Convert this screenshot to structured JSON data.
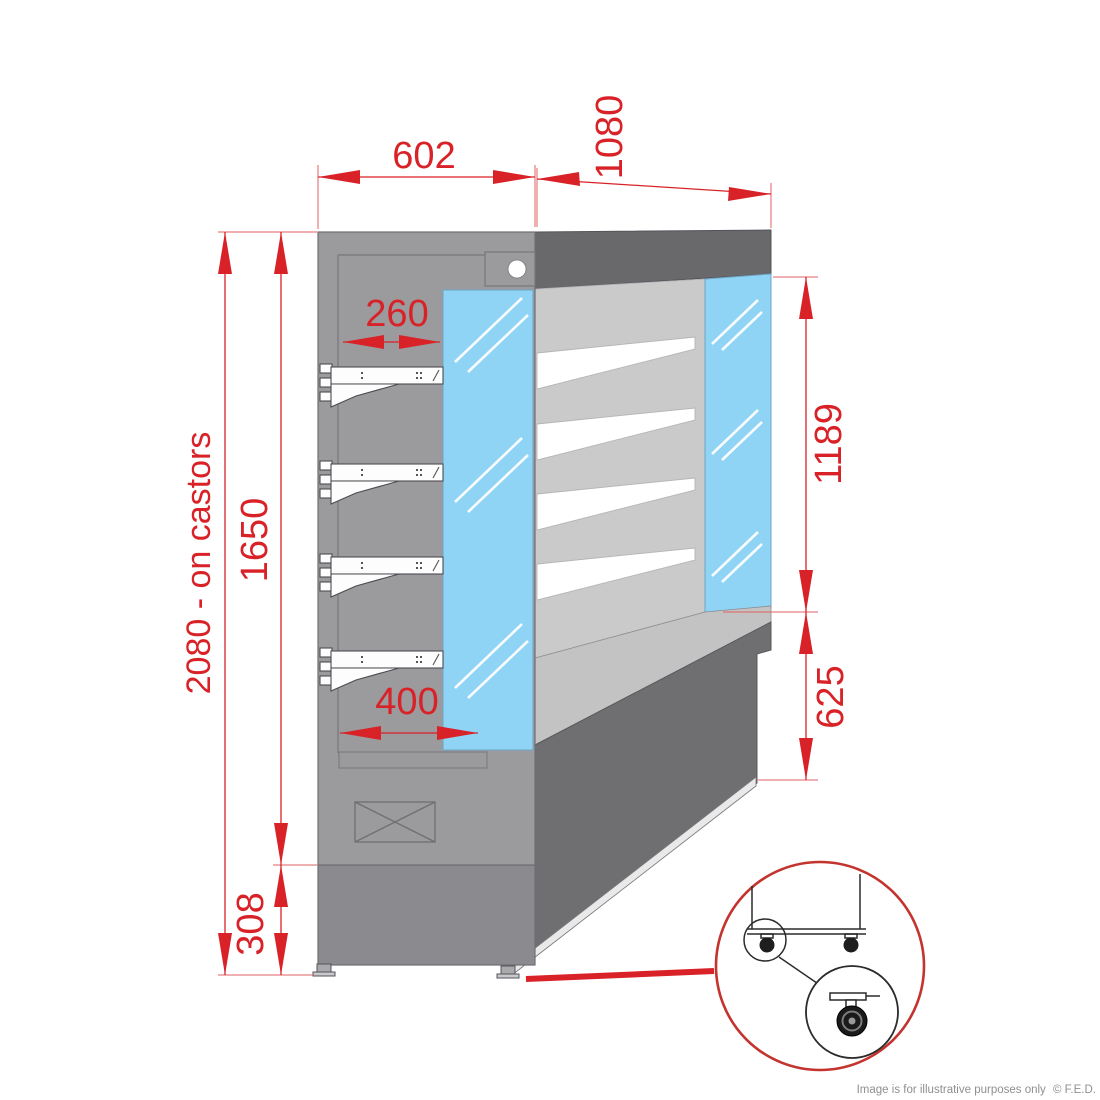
{
  "diagram": {
    "type": "product-dimension-drawing",
    "subject": "open display chiller side elevation on castors with castor detail callout",
    "dimensions": {
      "width_top": "602",
      "depth": "1080",
      "upper_shelf_depth": "260",
      "lower_shelf_depth": "400",
      "body_height": "1650",
      "overall_height": "2080 - on castors",
      "base_height": "308",
      "glass_front_height": "1189",
      "base_front_height": "625"
    },
    "colors": {
      "dimension_red": "#d92228",
      "glass_blue": "#8fd3f5",
      "cabinet_gray": "#9b9a9d",
      "dark_gray": "#69686b",
      "interior_gray": "#cbcaca",
      "base_gray": "#8b8a8e"
    },
    "detail_callout": "castor-detail",
    "footer": {
      "note": "Image is for illustrative purposes only",
      "copyright": "© F.E.D."
    }
  }
}
